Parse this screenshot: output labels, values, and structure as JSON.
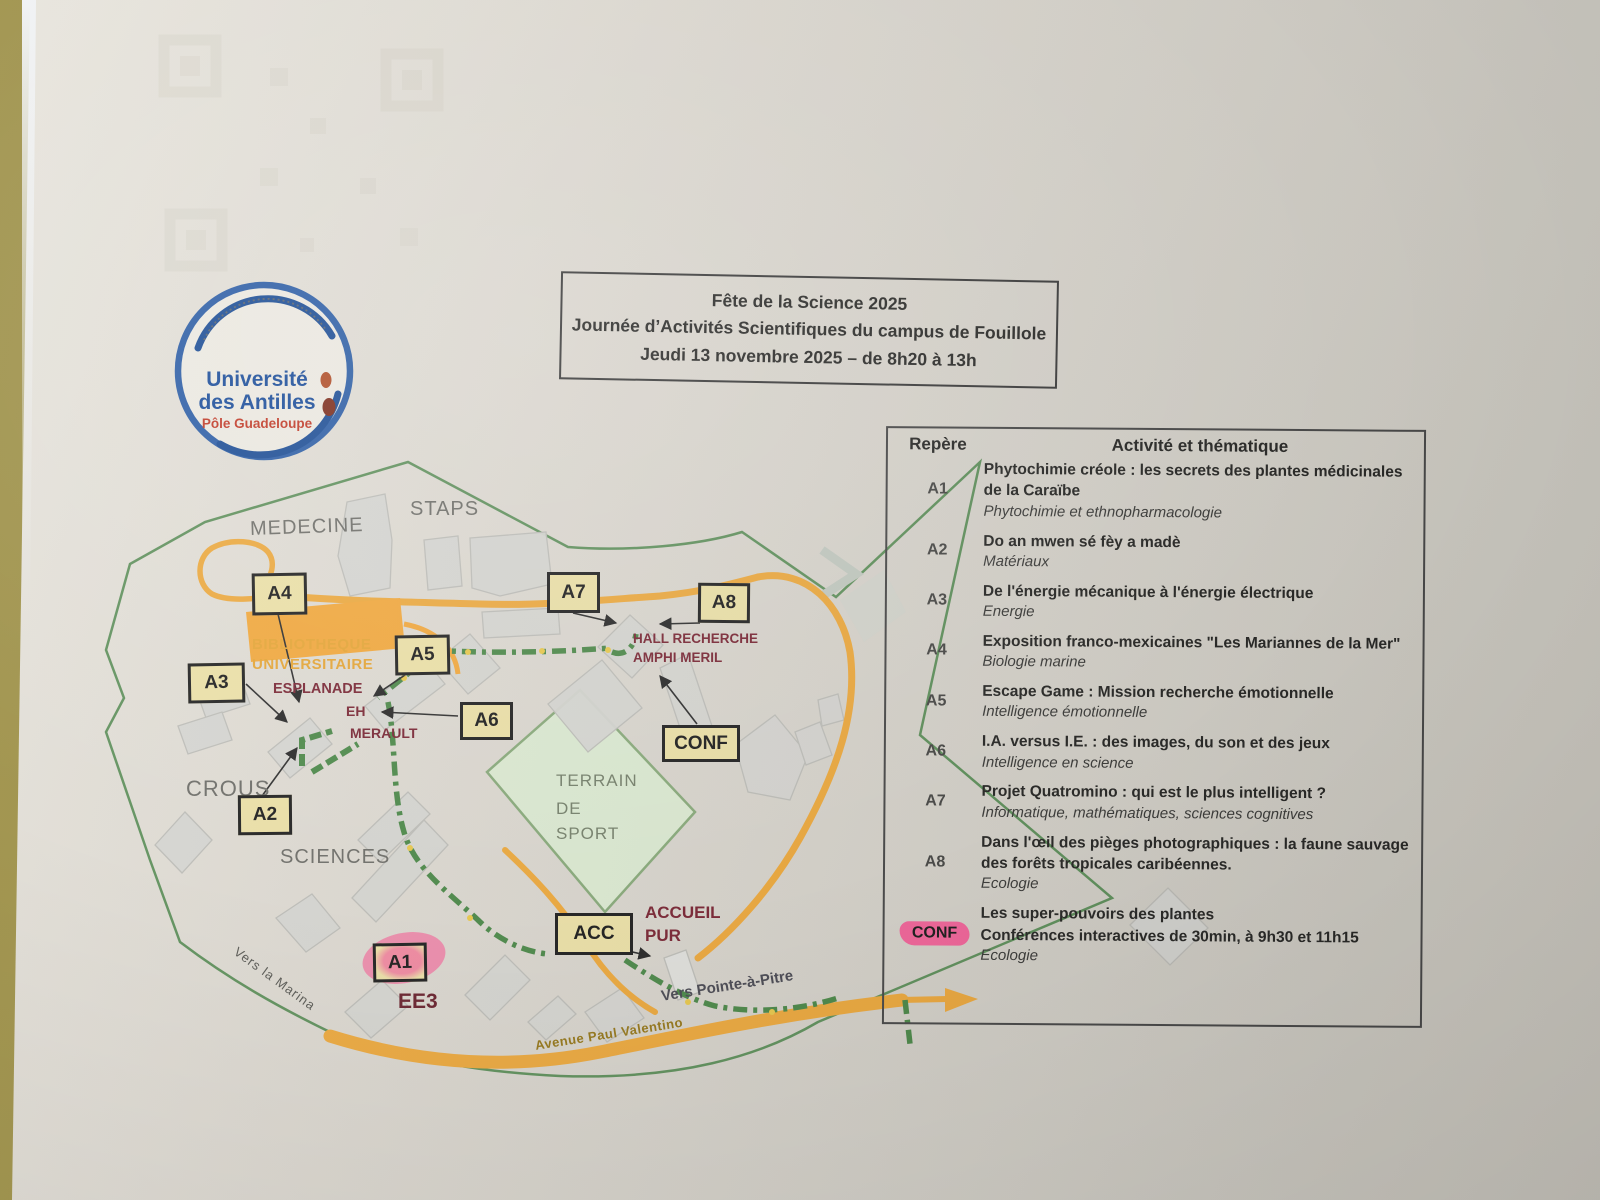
{
  "header_box": {
    "line1": "Fête de la Science 2025",
    "line2": "Journée d’Activités Scientifiques du campus de Fouillole",
    "line3": "Jeudi 13 novembre 2025 – de 8h20 à 13h"
  },
  "logo": {
    "line1": "Université",
    "line2": "des Antilles",
    "line3": "Pôle Guadeloupe"
  },
  "map": {
    "badges": [
      {
        "label": "A4"
      },
      {
        "label": "A7"
      },
      {
        "label": "A8"
      },
      {
        "label": "A5"
      },
      {
        "label": "A3"
      },
      {
        "label": "A6"
      },
      {
        "label": "CONF"
      },
      {
        "label": "A2"
      },
      {
        "label": "ACC"
      },
      {
        "label": "A1"
      }
    ],
    "labels": {
      "medecine": "MEDECINE",
      "staps": "STAPS",
      "bibliotheque_1": "BIBLIOTHEQUE",
      "bibliotheque_2": "UNIVERSITAIRE",
      "esplanade": "ESPLANADE",
      "eh": "EH",
      "merault": "MERAULT",
      "hall_recherche": "HALL RECHERCHE",
      "amphi_meril": "AMPHI MERIL",
      "crous": "CROUS",
      "terrain_1": "TERRAIN",
      "terrain_2": "DE",
      "terrain_3": "SPORT",
      "sciences": "SCIENCES",
      "accueil": "ACCUEIL",
      "pur": "PUR",
      "ee3": "EE3",
      "vers_marina": "Vers la Marina",
      "vers_pap": "Vers Pointe-à-Pitre",
      "avenue": "Avenue Paul Valentino"
    }
  },
  "table": {
    "header": {
      "col1": "Repère",
      "col2": "Activité et thématique"
    },
    "rows": [
      {
        "id": "A1",
        "title": "Phytochimie créole : les secrets des plantes médicinales de la Caraïbe",
        "theme": "Phytochimie et ethnopharmacologie"
      },
      {
        "id": "A2",
        "title": "Do an mwen sé fèy a madè",
        "theme": "Matériaux"
      },
      {
        "id": "A3",
        "title": "De l'énergie mécanique à l'énergie électrique",
        "theme": "Energie"
      },
      {
        "id": "A4",
        "title": "Exposition franco-mexicaines \"Les Mariannes de la Mer\"",
        "theme": "Biologie marine"
      },
      {
        "id": "A5",
        "title": "Escape Game : Mission recherche émotionnelle",
        "theme": "Intelligence émotionnelle"
      },
      {
        "id": "A6",
        "title": "I.A. versus I.E. : des images, du son et des jeux",
        "theme": "Intelligence en science"
      },
      {
        "id": "A7",
        "title": "Projet Quatromino : qui est le plus intelligent ?",
        "theme": "Informatique, mathématiques, sciences cognitives"
      },
      {
        "id": "A8",
        "title": "Dans l'œil des pièges photographiques : la faune sauvage des forêts tropicales caribéennes.",
        "theme": "Ecologie"
      },
      {
        "id": "CONF",
        "title": "Les super-pouvoirs des plantes",
        "subtitle": "Conférences interactives de 30min, à 9h30 et 11h15",
        "theme": "Ecologie"
      }
    ]
  },
  "colors": {
    "accent_blue": "#1d4e96",
    "accent_red": "#c23b28",
    "badge_yellow": "#ece1a8",
    "highlight_pink": "#f2679b",
    "road_orange": "#edaa40",
    "path_green": "#4e8a4b",
    "label_darkred": "#7b2836"
  }
}
